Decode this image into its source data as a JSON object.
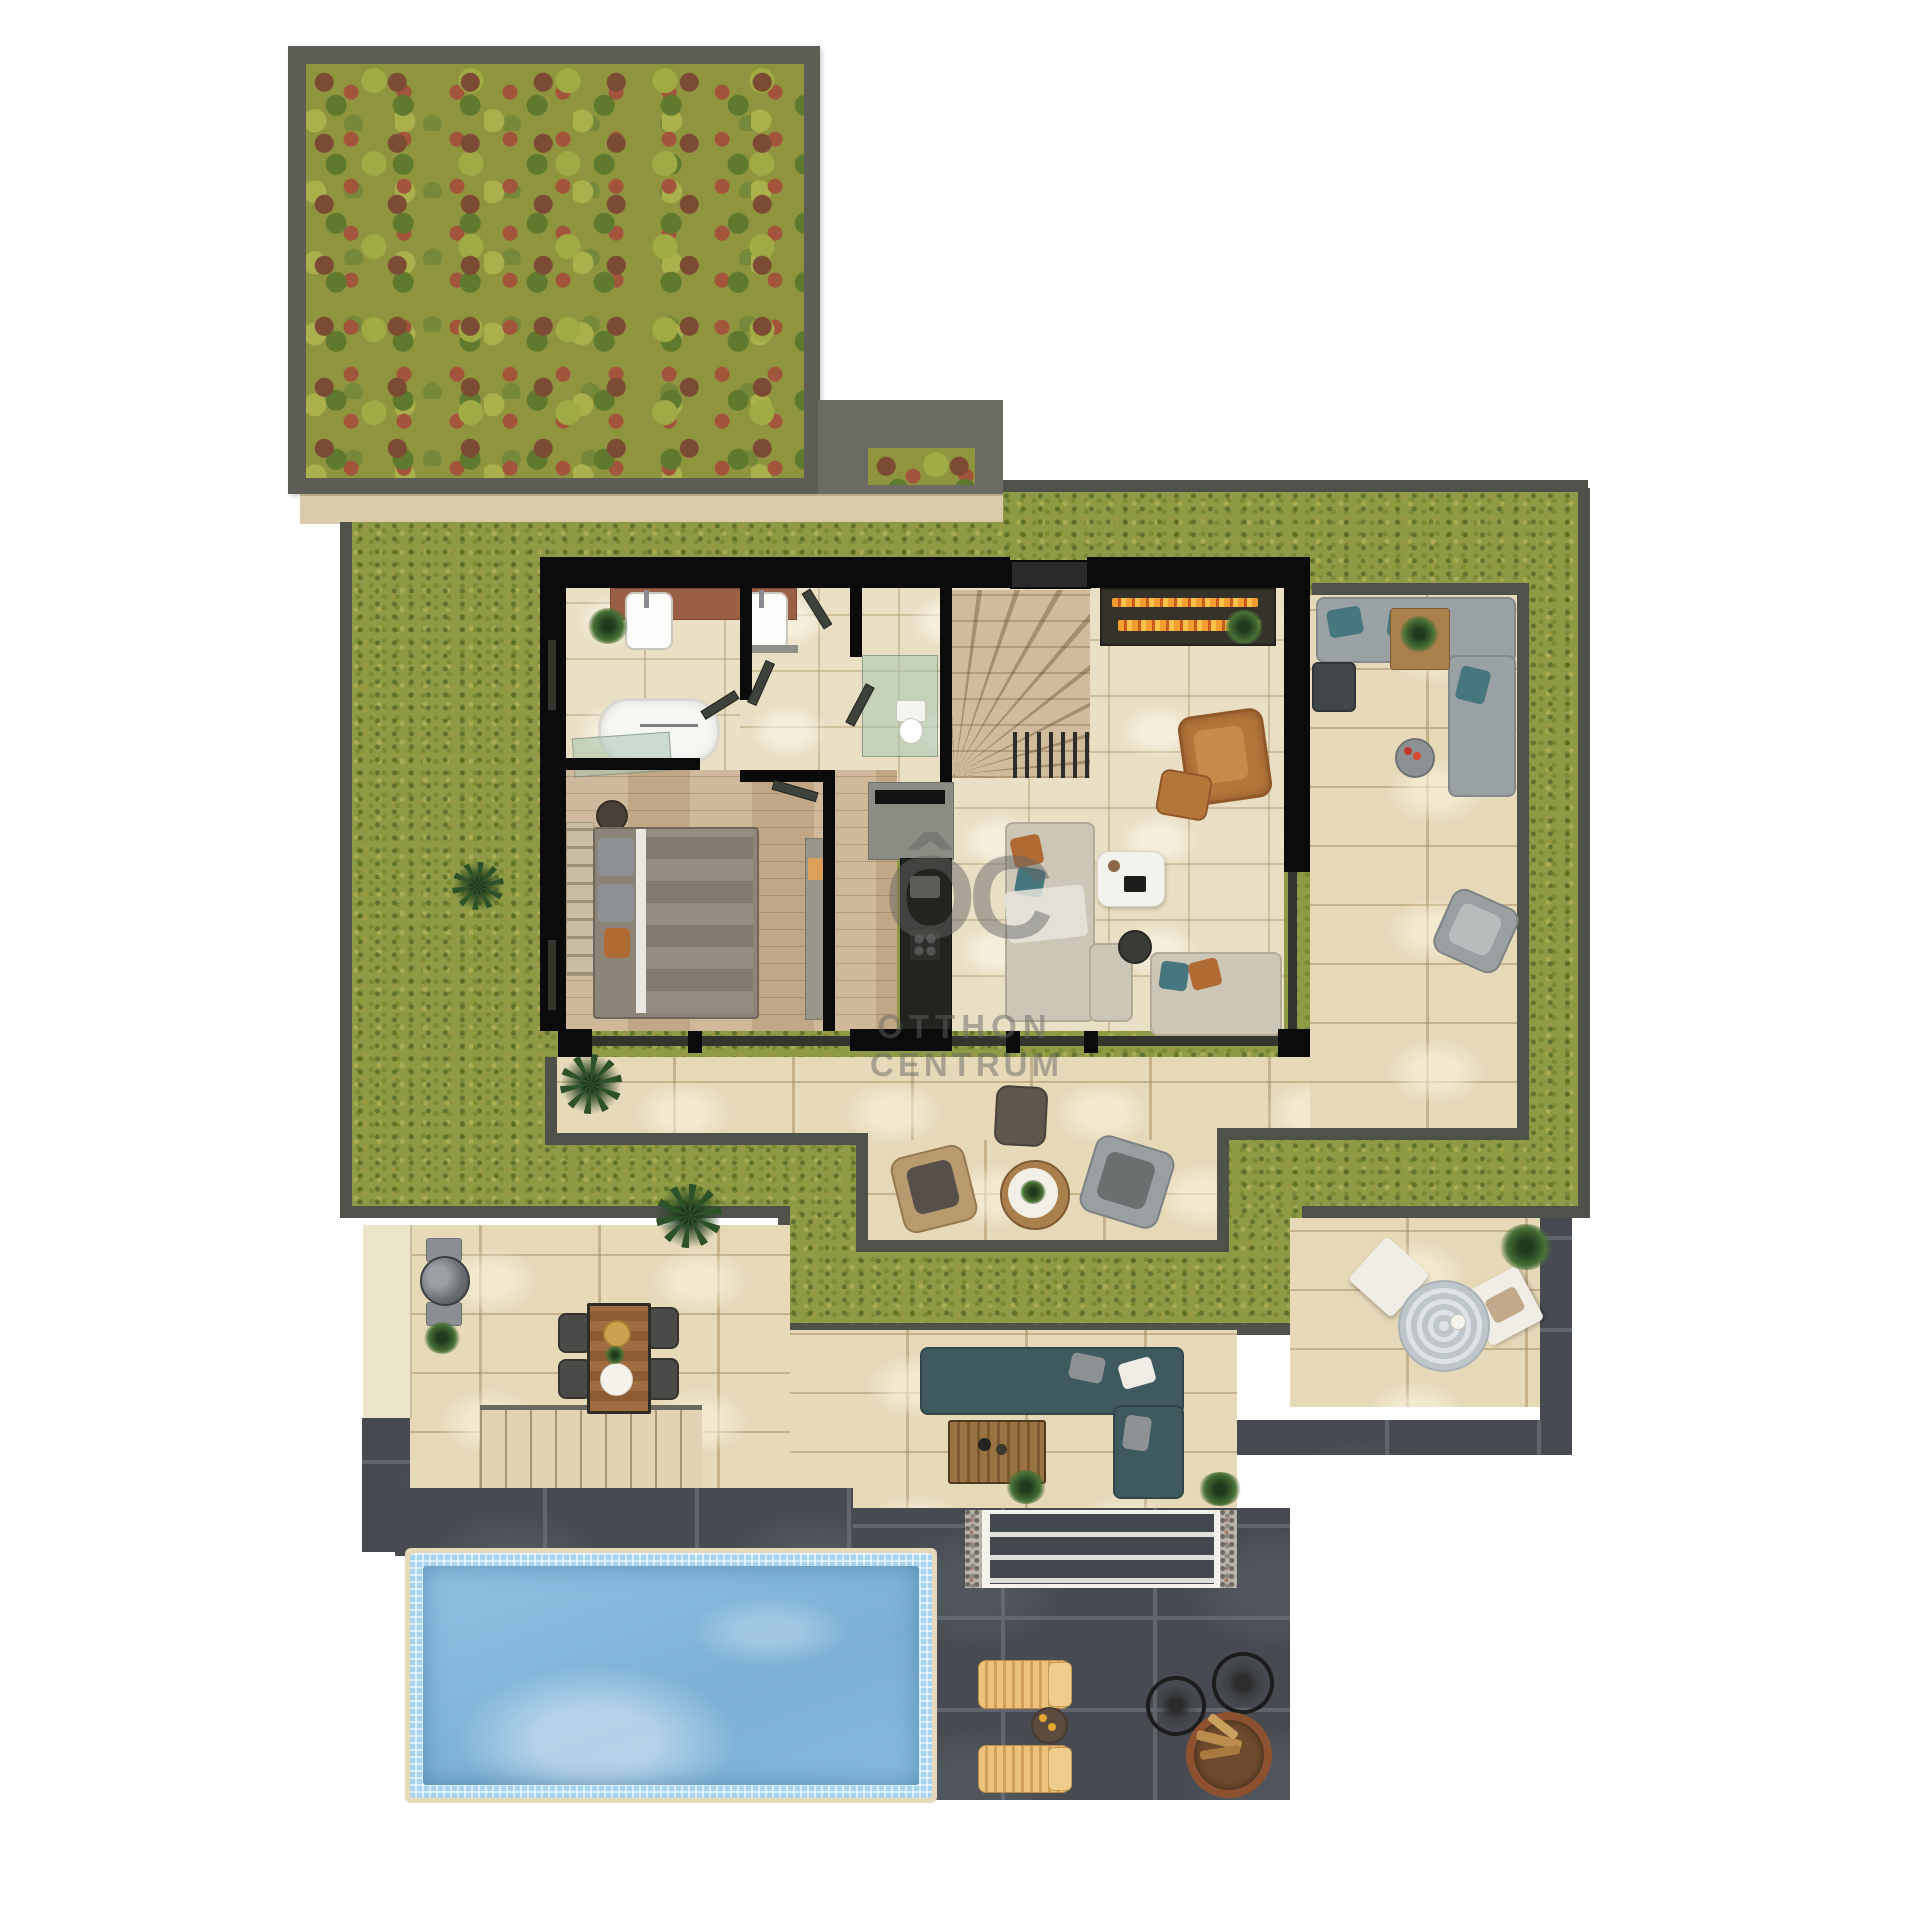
{
  "watermark": {
    "logo": "ÔC",
    "line1": "OTTHON",
    "line2": "CENTRUM"
  },
  "palette": {
    "background": "#ffffff",
    "moss_roof": "#8f953f",
    "roof_border": "#5e5e57",
    "fascia": "#d8cba9",
    "lawn": "#8e9a46",
    "lawn_edge": "#4f514b",
    "terrace_tile": "#e6d9b8",
    "interior_tile": "#e9dfc4",
    "wood_floor": "#c9b190",
    "wall": "#0b0b0b",
    "dark_pavement": "#474b51",
    "pool_water": "#85b8dc",
    "pool_mosaic": "#a9d4f1",
    "teal_sofa": "#3f5a5e",
    "cognac_leather": "#b5763b",
    "lounger_wood": "#e3b871",
    "flame": "#f39c2f"
  },
  "regions": [
    "green-roof",
    "garden-lawn",
    "bathroom",
    "bedroom",
    "hallway",
    "wc",
    "staircase",
    "living-room",
    "kitchen",
    "fireplace",
    "outdoor-lounge",
    "patio-seating",
    "lower-terrace",
    "outdoor-dining",
    "bbq-grill",
    "right-terrace",
    "garden-stairs",
    "entry-steps",
    "pool",
    "sun-loungers",
    "fire-pit"
  ]
}
